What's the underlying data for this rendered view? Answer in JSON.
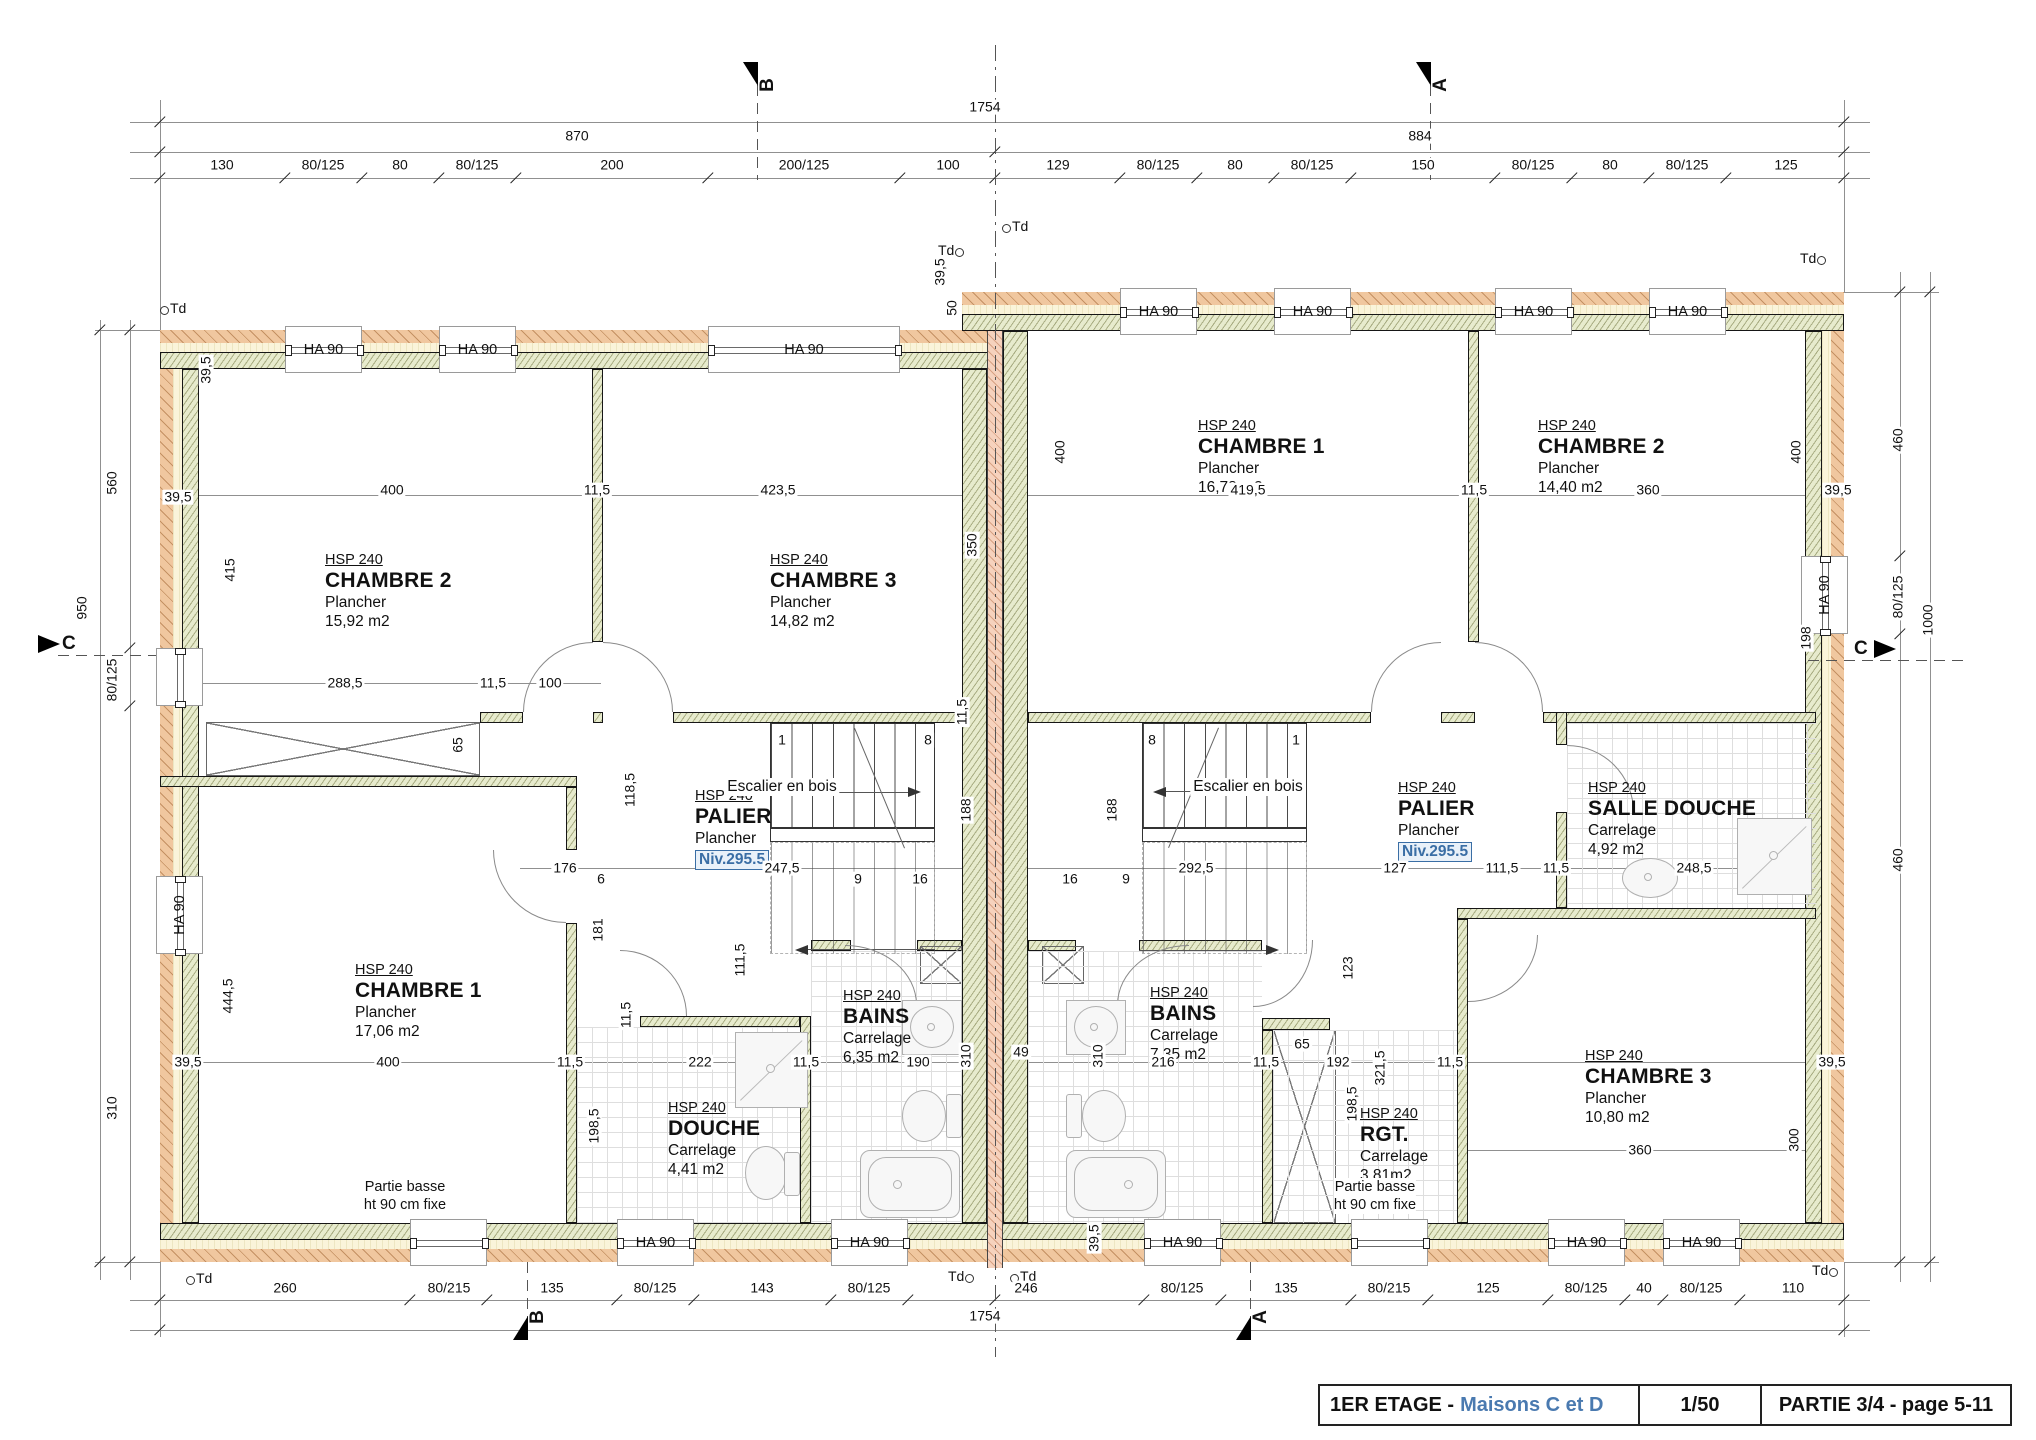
{
  "title_block": {
    "title_prefix": "1ER ETAGE -",
    "title_highlight": "Maisons C et D",
    "scale": "1/50",
    "part": "PARTIE 3/4 - page 5-11"
  },
  "labels": {
    "window": "HA 90",
    "stairs": "Escalier en bois",
    "td": "Td",
    "note_line1": "Partie basse",
    "note_line2": "ht 90 cm fixe"
  },
  "colors": {
    "cladding": "#f0c79f",
    "insulation": "#e7ebcd",
    "party_wall": "#f6d2bd",
    "accent_blue": "#4a7ab0",
    "niv_blue": "#3a6ea5"
  },
  "rooms": [
    {
      "hsp": "HSP 240",
      "name": "CHAMBRE 2",
      "lines": [
        "Plancher",
        "15,92 m2"
      ],
      "x": 325,
      "y": 552
    },
    {
      "hsp": "HSP 240",
      "name": "CHAMBRE 3",
      "lines": [
        "Plancher",
        "14,82 m2"
      ],
      "x": 770,
      "y": 552
    },
    {
      "hsp": "HSP 240",
      "name": "PALIER",
      "lines": [
        "Plancher"
      ],
      "niv": "Niv.295.5",
      "x": 695,
      "y": 788
    },
    {
      "hsp": "HSP 240",
      "name": "CHAMBRE 1",
      "lines": [
        "Plancher",
        "17,06 m2"
      ],
      "x": 355,
      "y": 962
    },
    {
      "hsp": "HSP 240",
      "name": "DOUCHE",
      "lines": [
        "Carrelage",
        "4,41 m2"
      ],
      "x": 668,
      "y": 1100
    },
    {
      "hsp": "HSP 240",
      "name": "BAINS",
      "lines": [
        "Carrelage",
        "6,35 m2"
      ],
      "x": 843,
      "y": 988
    },
    {
      "hsp": "HSP 240",
      "name": "CHAMBRE 1",
      "lines": [
        "Plancher",
        "16,78 m2"
      ],
      "x": 1198,
      "y": 418
    },
    {
      "hsp": "HSP 240",
      "name": "CHAMBRE 2",
      "lines": [
        "Plancher",
        "14,40 m2"
      ],
      "x": 1538,
      "y": 418
    },
    {
      "hsp": "HSP 240",
      "name": "PALIER",
      "lines": [
        "Plancher"
      ],
      "niv": "Niv.295.5",
      "x": 1398,
      "y": 780
    },
    {
      "hsp": "HSP 240",
      "name": "SALLE DOUCHE",
      "lines": [
        "Carrelage",
        "4,92 m2"
      ],
      "x": 1588,
      "y": 780
    },
    {
      "hsp": "HSP 240",
      "name": "BAINS",
      "lines": [
        "Carrelage",
        "7,35 m2"
      ],
      "x": 1150,
      "y": 985
    },
    {
      "hsp": "HSP 240",
      "name": "RGT.",
      "lines": [
        "Carrelage",
        "3,81m2"
      ],
      "x": 1360,
      "y": 1106
    },
    {
      "hsp": "HSP 240",
      "name": "CHAMBRE 3",
      "lines": [
        "Plancher",
        "10,80 m2"
      ],
      "x": 1585,
      "y": 1048
    }
  ],
  "dims": [
    {
      "t": "1754",
      "x": 985,
      "y": 107
    },
    {
      "t": "870",
      "x": 577,
      "y": 136
    },
    {
      "t": "884",
      "x": 1420,
      "y": 136
    },
    {
      "t": "130",
      "x": 222,
      "y": 165
    },
    {
      "t": "80/125",
      "x": 323,
      "y": 165
    },
    {
      "t": "80",
      "x": 400,
      "y": 165
    },
    {
      "t": "80/125",
      "x": 477,
      "y": 165
    },
    {
      "t": "200",
      "x": 612,
      "y": 165
    },
    {
      "t": "200/125",
      "x": 804,
      "y": 165
    },
    {
      "t": "100",
      "x": 948,
      "y": 165
    },
    {
      "t": "129",
      "x": 1058,
      "y": 165
    },
    {
      "t": "80/125",
      "x": 1158,
      "y": 165
    },
    {
      "t": "80",
      "x": 1235,
      "y": 165
    },
    {
      "t": "80/125",
      "x": 1312,
      "y": 165
    },
    {
      "t": "150",
      "x": 1423,
      "y": 165
    },
    {
      "t": "80/125",
      "x": 1533,
      "y": 165
    },
    {
      "t": "80",
      "x": 1610,
      "y": 165
    },
    {
      "t": "80/125",
      "x": 1687,
      "y": 165
    },
    {
      "t": "125",
      "x": 1786,
      "y": 165
    },
    {
      "t": "50",
      "x": 952,
      "y": 308,
      "r": 1
    },
    {
      "t": "560",
      "x": 112,
      "y": 483,
      "r": 1
    },
    {
      "t": "950",
      "x": 82,
      "y": 608,
      "r": 1
    },
    {
      "t": "80/125",
      "x": 112,
      "y": 680,
      "r": 1
    },
    {
      "t": "310",
      "x": 112,
      "y": 1108,
      "r": 1
    },
    {
      "t": "460",
      "x": 1898,
      "y": 440,
      "r": 1
    },
    {
      "t": "80/125",
      "x": 1898,
      "y": 597,
      "r": 1
    },
    {
      "t": "1000",
      "x": 1928,
      "y": 620,
      "r": 1
    },
    {
      "t": "460",
      "x": 1898,
      "y": 860,
      "r": 1
    },
    {
      "t": "400",
      "x": 392,
      "y": 490
    },
    {
      "t": "11,5",
      "x": 597,
      "y": 490
    },
    {
      "t": "423,5",
      "x": 778,
      "y": 490
    },
    {
      "t": "419,5",
      "x": 1248,
      "y": 490
    },
    {
      "t": "11,5",
      "x": 1474,
      "y": 490
    },
    {
      "t": "360",
      "x": 1648,
      "y": 490
    },
    {
      "t": "39,5",
      "x": 206,
      "y": 370,
      "r": 1
    },
    {
      "t": "39,5",
      "x": 178,
      "y": 497
    },
    {
      "t": "415",
      "x": 230,
      "y": 570,
      "r": 1
    },
    {
      "t": "400",
      "x": 1060,
      "y": 452,
      "r": 1
    },
    {
      "t": "400",
      "x": 1796,
      "y": 452,
      "r": 1
    },
    {
      "t": "39,5",
      "x": 1838,
      "y": 490
    },
    {
      "t": "350",
      "x": 972,
      "y": 545,
      "r": 1
    },
    {
      "t": "39,5",
      "x": 940,
      "y": 272,
      "r": 1
    },
    {
      "t": "288,5",
      "x": 345,
      "y": 683
    },
    {
      "t": "11,5",
      "x": 493,
      "y": 683
    },
    {
      "t": "100",
      "x": 550,
      "y": 683
    },
    {
      "t": "65",
      "x": 458,
      "y": 745,
      "r": 1
    },
    {
      "t": "118,5",
      "x": 630,
      "y": 790,
      "r": 1
    },
    {
      "t": "11,5",
      "x": 962,
      "y": 712,
      "r": 1
    },
    {
      "t": "1",
      "x": 782,
      "y": 740
    },
    {
      "t": "8",
      "x": 928,
      "y": 740
    },
    {
      "t": "8",
      "x": 1152,
      "y": 740
    },
    {
      "t": "1",
      "x": 1296,
      "y": 740
    },
    {
      "t": "188",
      "x": 966,
      "y": 810,
      "r": 1
    },
    {
      "t": "188",
      "x": 1112,
      "y": 810,
      "r": 1
    },
    {
      "t": "176",
      "x": 565,
      "y": 868
    },
    {
      "t": "6",
      "x": 601,
      "y": 879
    },
    {
      "t": "247,5",
      "x": 782,
      "y": 868
    },
    {
      "t": "9",
      "x": 858,
      "y": 879
    },
    {
      "t": "16",
      "x": 920,
      "y": 879
    },
    {
      "t": "16",
      "x": 1070,
      "y": 879
    },
    {
      "t": "9",
      "x": 1126,
      "y": 879
    },
    {
      "t": "292,5",
      "x": 1196,
      "y": 868
    },
    {
      "t": "127",
      "x": 1395,
      "y": 868
    },
    {
      "t": "111,5",
      "x": 1502,
      "y": 868
    },
    {
      "t": "11,5",
      "x": 1556,
      "y": 868
    },
    {
      "t": "248,5",
      "x": 1694,
      "y": 868
    },
    {
      "t": "181",
      "x": 598,
      "y": 930,
      "r": 1
    },
    {
      "t": "111,5",
      "x": 740,
      "y": 960,
      "r": 1
    },
    {
      "t": "11,5",
      "x": 626,
      "y": 1015,
      "r": 1
    },
    {
      "t": "123",
      "x": 1348,
      "y": 968,
      "r": 1
    },
    {
      "t": "321,5",
      "x": 1380,
      "y": 1068,
      "r": 1
    },
    {
      "t": "198",
      "x": 1806,
      "y": 638,
      "r": 1
    },
    {
      "t": "39,5",
      "x": 188,
      "y": 1062
    },
    {
      "t": "400",
      "x": 388,
      "y": 1062
    },
    {
      "t": "11,5",
      "x": 570,
      "y": 1062
    },
    {
      "t": "222",
      "x": 700,
      "y": 1062
    },
    {
      "t": "11,5",
      "x": 806,
      "y": 1062
    },
    {
      "t": "190",
      "x": 918,
      "y": 1062
    },
    {
      "t": "310",
      "x": 966,
      "y": 1056,
      "r": 1
    },
    {
      "t": "49",
      "x": 1021,
      "y": 1052
    },
    {
      "t": "310",
      "x": 1098,
      "y": 1056,
      "r": 1
    },
    {
      "t": "216",
      "x": 1163,
      "y": 1062
    },
    {
      "t": "11,5",
      "x": 1266,
      "y": 1062
    },
    {
      "t": "65",
      "x": 1302,
      "y": 1044
    },
    {
      "t": "192",
      "x": 1338,
      "y": 1062
    },
    {
      "t": "11,5",
      "x": 1450,
      "y": 1062
    },
    {
      "t": "39,5",
      "x": 1832,
      "y": 1062
    },
    {
      "t": "198,5",
      "x": 594,
      "y": 1126,
      "r": 1
    },
    {
      "t": "198,5",
      "x": 1352,
      "y": 1104,
      "r": 1
    },
    {
      "t": "444,5",
      "x": 228,
      "y": 996,
      "r": 1
    },
    {
      "t": "360",
      "x": 1640,
      "y": 1150
    },
    {
      "t": "300",
      "x": 1794,
      "y": 1140,
      "r": 1
    },
    {
      "t": "39,5",
      "x": 1094,
      "y": 1238,
      "r": 1
    },
    {
      "t": "260",
      "x": 285,
      "y": 1288
    },
    {
      "t": "80/215",
      "x": 449,
      "y": 1288
    },
    {
      "t": "135",
      "x": 552,
      "y": 1288
    },
    {
      "t": "80/125",
      "x": 655,
      "y": 1288
    },
    {
      "t": "143",
      "x": 762,
      "y": 1288
    },
    {
      "t": "80/125",
      "x": 869,
      "y": 1288
    },
    {
      "t": "246",
      "x": 1026,
      "y": 1288
    },
    {
      "t": "80/125",
      "x": 1182,
      "y": 1288
    },
    {
      "t": "135",
      "x": 1286,
      "y": 1288
    },
    {
      "t": "80/215",
      "x": 1389,
      "y": 1288
    },
    {
      "t": "125",
      "x": 1488,
      "y": 1288
    },
    {
      "t": "80/125",
      "x": 1586,
      "y": 1288
    },
    {
      "t": "40",
      "x": 1644,
      "y": 1288
    },
    {
      "t": "80/125",
      "x": 1701,
      "y": 1288
    },
    {
      "t": "110",
      "x": 1793,
      "y": 1288
    },
    {
      "t": "1754",
      "x": 985,
      "y": 1316
    }
  ],
  "stair_labels": [
    {
      "x": 782,
      "y": 787
    },
    {
      "x": 1248,
      "y": 787
    }
  ],
  "notes": [
    {
      "x": 405,
      "y": 1178
    },
    {
      "x": 1375,
      "y": 1178
    }
  ],
  "section_markers": [
    {
      "l": "B",
      "x": 757,
      "y": 62,
      "o": "top"
    },
    {
      "l": "A",
      "x": 1430,
      "y": 62,
      "o": "top"
    },
    {
      "l": "B",
      "x": 527,
      "y": 1340,
      "o": "bottom"
    },
    {
      "l": "A",
      "x": 1250,
      "y": 1340,
      "o": "bottom"
    },
    {
      "l": "C",
      "x": 62,
      "y": 645,
      "o": "left"
    },
    {
      "l": "C",
      "x": 1872,
      "y": 650,
      "o": "right"
    }
  ],
  "td_marks": [
    {
      "x": 160,
      "y": 300,
      "f": 0
    },
    {
      "x": 938,
      "y": 242,
      "f": 1
    },
    {
      "x": 1002,
      "y": 218,
      "f": 0
    },
    {
      "x": 1800,
      "y": 250,
      "f": 1
    },
    {
      "x": 186,
      "y": 1270,
      "f": 0
    },
    {
      "x": 948,
      "y": 1268,
      "f": 1
    },
    {
      "x": 1010,
      "y": 1268,
      "f": 0
    },
    {
      "x": 1812,
      "y": 1262,
      "f": 1
    }
  ]
}
